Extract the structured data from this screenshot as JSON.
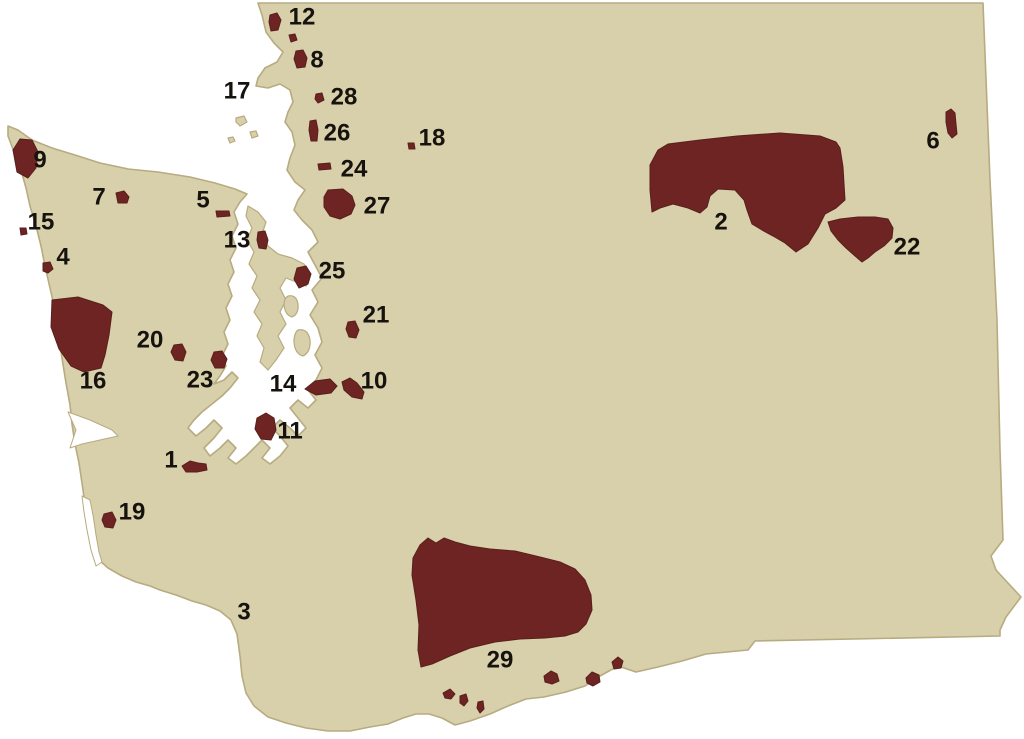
{
  "map": {
    "title": "Washington state map with numbered reservation areas",
    "colors": {
      "background": "#ffffff",
      "land": "#d8cfab",
      "land_border": "#b7ab80",
      "water": "#ffffff",
      "reservation": "#6e2423",
      "reservation_border": "#58201c",
      "label": "#16120e"
    },
    "marker_font_size": 24,
    "markers": [
      {
        "label": "1",
        "x": 171,
        "y": 460
      },
      {
        "label": "2",
        "x": 721,
        "y": 222
      },
      {
        "label": "3",
        "x": 244,
        "y": 612
      },
      {
        "label": "4",
        "x": 63,
        "y": 257
      },
      {
        "label": "5",
        "x": 203,
        "y": 200
      },
      {
        "label": "6",
        "x": 933,
        "y": 141
      },
      {
        "label": "7",
        "x": 99,
        "y": 197
      },
      {
        "label": "8",
        "x": 317,
        "y": 60
      },
      {
        "label": "9",
        "x": 40,
        "y": 160
      },
      {
        "label": "10",
        "x": 374,
        "y": 381
      },
      {
        "label": "11",
        "x": 290,
        "y": 431
      },
      {
        "label": "12",
        "x": 302,
        "y": 17
      },
      {
        "label": "13",
        "x": 237,
        "y": 240
      },
      {
        "label": "14",
        "x": 283,
        "y": 384
      },
      {
        "label": "15",
        "x": 41,
        "y": 222
      },
      {
        "label": "16",
        "x": 93,
        "y": 381
      },
      {
        "label": "17",
        "x": 237,
        "y": 91
      },
      {
        "label": "18",
        "x": 432,
        "y": 138
      },
      {
        "label": "19",
        "x": 132,
        "y": 512
      },
      {
        "label": "20",
        "x": 150,
        "y": 340
      },
      {
        "label": "21",
        "x": 376,
        "y": 315
      },
      {
        "label": "22",
        "x": 907,
        "y": 247
      },
      {
        "label": "23",
        "x": 200,
        "y": 380
      },
      {
        "label": "24",
        "x": 354,
        "y": 169
      },
      {
        "label": "25",
        "x": 332,
        "y": 271
      },
      {
        "label": "26",
        "x": 337,
        "y": 133
      },
      {
        "label": "27",
        "x": 377,
        "y": 206
      },
      {
        "label": "28",
        "x": 344,
        "y": 97
      },
      {
        "label": "29",
        "x": 500,
        "y": 660
      }
    ]
  }
}
